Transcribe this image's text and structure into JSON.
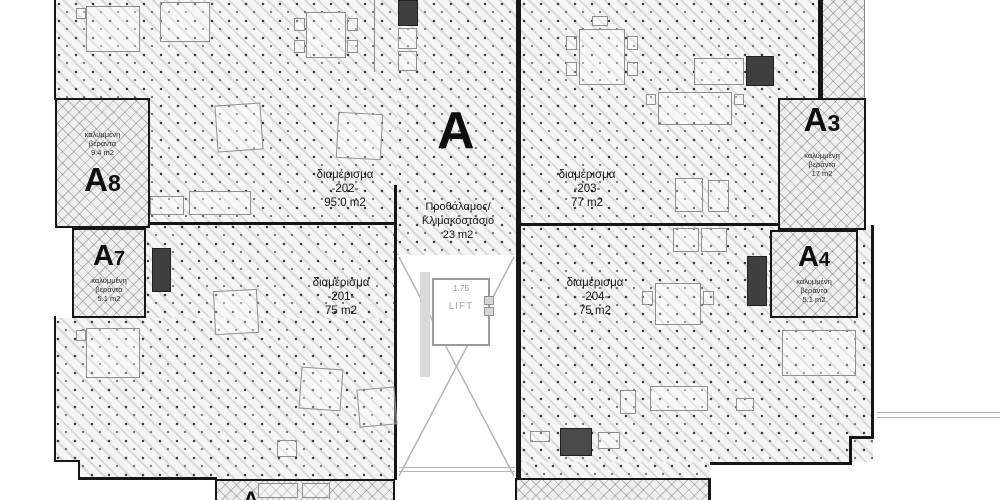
{
  "plan": {
    "building_label": "A",
    "hall": {
      "name_line1": "Προθάλαμος/",
      "name_line2": "Κλιμακοστάσιο",
      "area": "23 m2"
    },
    "lift": {
      "width_label": "1.75",
      "label": "LIFT"
    },
    "apartments": [
      {
        "name": "διαμέρισμα",
        "number": "-202-",
        "area": "95.0 m2"
      },
      {
        "name": "διαμέρισμα",
        "number": "-203-",
        "area": "77 m2"
      },
      {
        "name": "διαμέρισμα",
        "number": "-201-",
        "area": "75 m2"
      },
      {
        "name": "διαμέρισμα",
        "number": "-204-",
        "area": "75 m2"
      }
    ],
    "verandas": [
      {
        "letter": "A",
        "digit": "8",
        "desc_line1": "καλυμμένη",
        "desc_line2": "βεράντα",
        "area": "9.4 m2"
      },
      {
        "letter": "A",
        "digit": "7",
        "desc_line1": "καλυμμένη",
        "desc_line2": "βεράντα",
        "area": "5.1 m2"
      },
      {
        "letter": "A",
        "digit": "3",
        "desc_line1": "καλυμμένη",
        "desc_line2": "βεράντα",
        "area": "17 m2"
      },
      {
        "letter": "A",
        "digit": "4",
        "desc_line1": "καλυμμένη",
        "desc_line2": "βεράντα",
        "area": "5.1 m2"
      }
    ],
    "clipped_label": "A"
  },
  "colors": {
    "wall": "#161616",
    "floor": "#f5f5f5",
    "veranda": "#efefef",
    "lift_text": "#9a9a9a"
  }
}
